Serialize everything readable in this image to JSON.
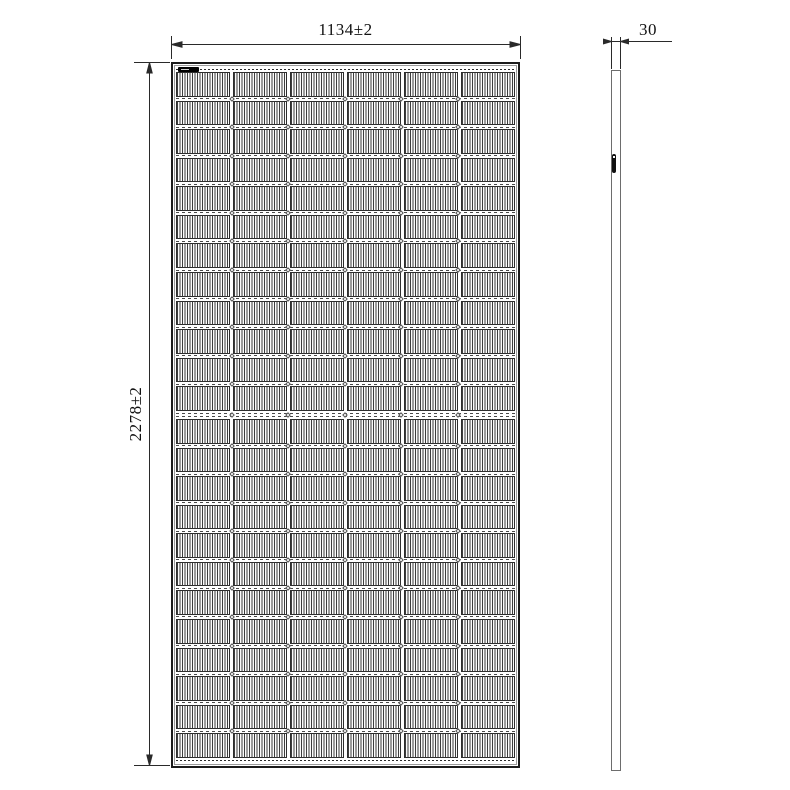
{
  "dimensions": {
    "width_label": "1134±2",
    "height_label": "2278±2",
    "thickness_label": "30"
  },
  "panel": {
    "grid": {
      "columns": 6,
      "rows": 24,
      "mid_gap_after_row": 12
    },
    "colors": {
      "frame_line": "#1b1b1b",
      "inner_frame_line": "#9a9a9a",
      "cell_hatch": "#3d3d3d",
      "dimension_line": "#2a2a2a",
      "label_mark": "#000000"
    },
    "marks": {
      "top_left_label": "serial-barcode-label",
      "side_mark": "junction-box-mark"
    }
  }
}
